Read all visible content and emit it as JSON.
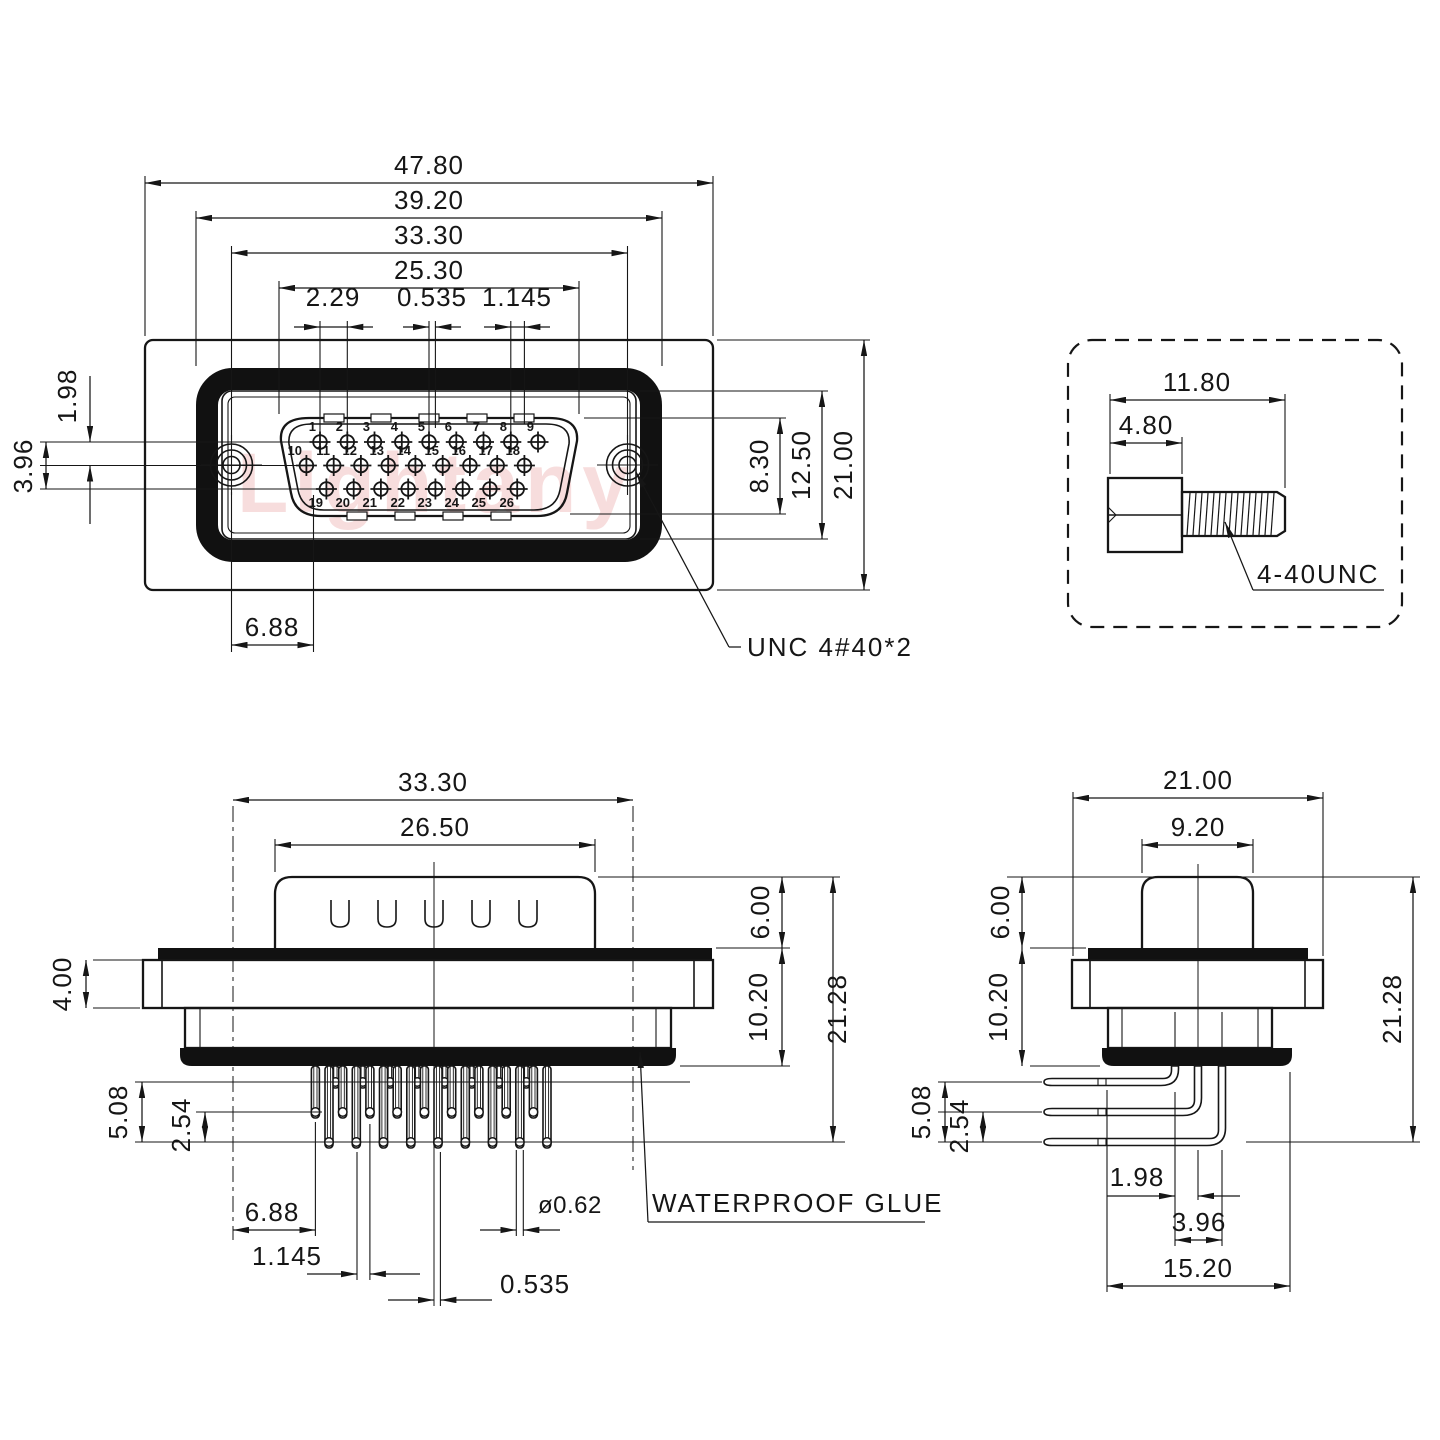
{
  "watermark": "Lightany",
  "front_view": {
    "flange_width": "47.80",
    "seal_width": "39.20",
    "hole_spacing": "33.30",
    "shell_width": "25.30",
    "pin_pitch": "2.29",
    "row_center_offset": "0.535",
    "row_half_pitch": "1.145",
    "row_gap": "1.98",
    "row_span": "3.96",
    "shell_height": "8.30",
    "insert_height": "12.50",
    "flange_height": "21.00",
    "hole_to_pin": "6.88",
    "screw_note": "UNC 4#40*2",
    "pins": [
      "1",
      "2",
      "3",
      "4",
      "5",
      "6",
      "7",
      "8",
      "9",
      "10",
      "11",
      "12",
      "13",
      "14",
      "15",
      "16",
      "17",
      "18",
      "19",
      "20",
      "21",
      "22",
      "23",
      "24",
      "25",
      "26"
    ]
  },
  "screw_detail": {
    "total_length": "11.80",
    "head_length": "4.80",
    "thread_spec": "4-40UNC"
  },
  "side_view": {
    "body_width": "33.30",
    "shell_width": "26.50",
    "flange_thickness": "4.00",
    "shell_height": "6.00",
    "body_height": "10.20",
    "total_height": "21.28",
    "pin_stagger": "5.08",
    "pin_step": "2.54",
    "hole_to_pin": "6.88",
    "tail_offset": "1.145",
    "tail_center_offset": "0.535",
    "pin_diameter": "ø0.62",
    "glue_note": "WATERPROOF GLUE"
  },
  "profile_view": {
    "flange_width": "21.00",
    "shell_width": "9.20",
    "shell_height": "6.00",
    "body_height": "10.20",
    "pin_stagger": "5.08",
    "pin_step": "2.54",
    "total_height": "21.28",
    "row_gap": "1.98",
    "row_span": "3.96",
    "tail_span": "15.20"
  }
}
